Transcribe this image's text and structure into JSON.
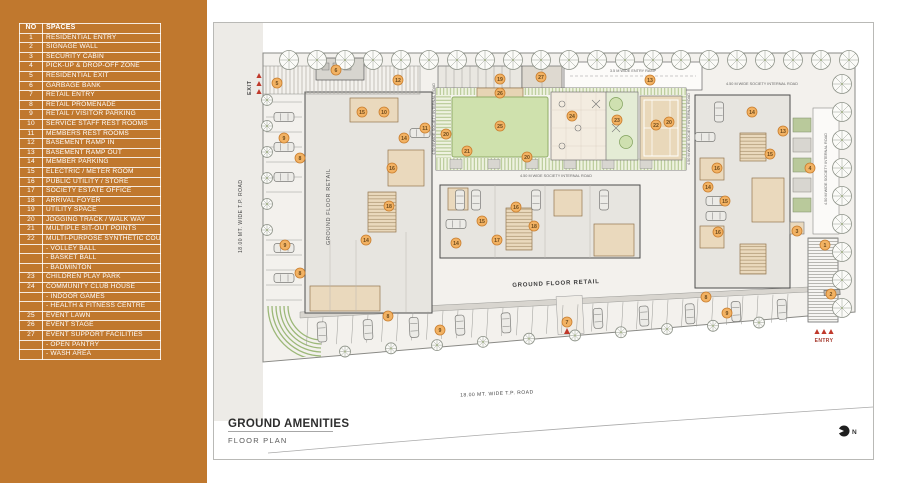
{
  "legend": {
    "header": {
      "no": "NO",
      "spaces": "SPACES"
    },
    "rows": [
      {
        "no": "1",
        "label": "RESIDENTIAL ENTRY"
      },
      {
        "no": "2",
        "label": "SIGNAGE WALL"
      },
      {
        "no": "3",
        "label": "SECURITY CABIN"
      },
      {
        "no": "4",
        "label": "PICK-UP & DROP-OFF ZONE"
      },
      {
        "no": "5",
        "label": "RESIDENTIAL EXIT"
      },
      {
        "no": "6",
        "label": "GARBAGE BANK"
      },
      {
        "no": "7",
        "label": "RETAIL ENTRY"
      },
      {
        "no": "8",
        "label": "RETAIL PROMENADE"
      },
      {
        "no": "9",
        "label": "RETAIL / VISITOR PARKING"
      },
      {
        "no": "10",
        "label": "SERVICE STAFF REST ROOMS"
      },
      {
        "no": "11",
        "label": "MEMBERS REST ROOMS"
      },
      {
        "no": "12",
        "label": "BASEMENT RAMP IN"
      },
      {
        "no": "13",
        "label": "BASEMENT RAMP OUT"
      },
      {
        "no": "14",
        "label": "MEMBER PARKING"
      },
      {
        "no": "15",
        "label": "ELECTRIC / METER ROOM"
      },
      {
        "no": "16",
        "label": "PUBLIC UTILITY / STORE"
      },
      {
        "no": "17",
        "label": "SOCIETY ESTATE OFFICE"
      },
      {
        "no": "18",
        "label": "ARRIVAL FOYER"
      },
      {
        "no": "19",
        "label": "UTILITY SPACE"
      },
      {
        "no": "20",
        "label": "JOGGING TRACK / WALK WAY"
      },
      {
        "no": "21",
        "label": "MULTIPLE SIT-OUT POINTS"
      },
      {
        "no": "22",
        "label": "MULTI-PURPOSE SYNTHETIC COURT"
      },
      {
        "no": "",
        "label": "- VOLLEY BALL"
      },
      {
        "no": "",
        "label": "- BASKET BALL"
      },
      {
        "no": "",
        "label": "- BADMINTON"
      },
      {
        "no": "23",
        "label": "CHILDREN PLAY PARK"
      },
      {
        "no": "24",
        "label": "COMMUNITY CLUB HOUSE"
      },
      {
        "no": "",
        "label": "- INDOOR GAMES"
      },
      {
        "no": "",
        "label": "- HEALTH & FITNESS CENTRE"
      },
      {
        "no": "25",
        "label": "EVENT LAWN"
      },
      {
        "no": "26",
        "label": "EVENT STAGE"
      },
      {
        "no": "27",
        "label": "EVENT SUPPORT FACILITIES"
      },
      {
        "no": "",
        "label": "- OPEN PANTRY"
      },
      {
        "no": "",
        "label": "- WASH AREA"
      }
    ]
  },
  "title": {
    "heading": "GROUND AMENITIES",
    "subheading": "FLOOR PLAN"
  },
  "plan": {
    "labels": {
      "tp_road": "18.00 MT. WIDE T.P. ROAD",
      "internal_road": "4.50 M WIDE SOCIETY INTERNAL ROAD",
      "entry_ramp": "3.5 M WIDE ENTRY RAMP",
      "ground_floor_retail": "GROUND FLOOR RETAIL",
      "exit": "EXIT",
      "entry": "ENTRY",
      "north": "N"
    },
    "markers": [
      {
        "n": "5",
        "x": 277,
        "y": 83
      },
      {
        "n": "6",
        "x": 336,
        "y": 70
      },
      {
        "n": "12",
        "x": 398,
        "y": 80
      },
      {
        "n": "19",
        "x": 500,
        "y": 79
      },
      {
        "n": "27",
        "x": 541,
        "y": 77
      },
      {
        "n": "13",
        "x": 650,
        "y": 80
      },
      {
        "n": "26",
        "x": 500,
        "y": 93
      },
      {
        "n": "25",
        "x": 500,
        "y": 126
      },
      {
        "n": "24",
        "x": 572,
        "y": 116
      },
      {
        "n": "23",
        "x": 617,
        "y": 120
      },
      {
        "n": "22",
        "x": 656,
        "y": 125
      },
      {
        "n": "20",
        "x": 446,
        "y": 134
      },
      {
        "n": "21",
        "x": 467,
        "y": 151
      },
      {
        "n": "20",
        "x": 527,
        "y": 157
      },
      {
        "n": "20",
        "x": 669,
        "y": 122
      },
      {
        "n": "9",
        "x": 284,
        "y": 138
      },
      {
        "n": "8",
        "x": 300,
        "y": 158
      },
      {
        "n": "9",
        "x": 285,
        "y": 245
      },
      {
        "n": "8",
        "x": 300,
        "y": 273
      },
      {
        "n": "15",
        "x": 362,
        "y": 112
      },
      {
        "n": "10",
        "x": 384,
        "y": 112
      },
      {
        "n": "14",
        "x": 404,
        "y": 138
      },
      {
        "n": "16",
        "x": 392,
        "y": 168
      },
      {
        "n": "11",
        "x": 425,
        "y": 128
      },
      {
        "n": "18",
        "x": 389,
        "y": 206
      },
      {
        "n": "14",
        "x": 366,
        "y": 240
      },
      {
        "n": "16",
        "x": 516,
        "y": 207
      },
      {
        "n": "15",
        "x": 482,
        "y": 221
      },
      {
        "n": "18",
        "x": 534,
        "y": 226
      },
      {
        "n": "14",
        "x": 456,
        "y": 243
      },
      {
        "n": "17",
        "x": 497,
        "y": 240
      },
      {
        "n": "14",
        "x": 752,
        "y": 112
      },
      {
        "n": "13",
        "x": 783,
        "y": 131
      },
      {
        "n": "15",
        "x": 770,
        "y": 154
      },
      {
        "n": "16",
        "x": 717,
        "y": 168
      },
      {
        "n": "4",
        "x": 810,
        "y": 168
      },
      {
        "n": "14",
        "x": 708,
        "y": 187
      },
      {
        "n": "15",
        "x": 725,
        "y": 201
      },
      {
        "n": "16",
        "x": 718,
        "y": 232
      },
      {
        "n": "3",
        "x": 797,
        "y": 231
      },
      {
        "n": "1",
        "x": 825,
        "y": 245
      },
      {
        "n": "2",
        "x": 831,
        "y": 294
      },
      {
        "n": "8",
        "x": 388,
        "y": 316
      },
      {
        "n": "9",
        "x": 440,
        "y": 330
      },
      {
        "n": "7",
        "x": 567,
        "y": 322
      },
      {
        "n": "8",
        "x": 706,
        "y": 297
      },
      {
        "n": "9",
        "x": 727,
        "y": 313
      }
    ]
  },
  "colors": {
    "panel": "#c0782e",
    "marker_fill": "#f2b263",
    "marker_stroke": "#c97e2e",
    "lawn": "#cfe1ad",
    "accent_red": "#b03328"
  }
}
